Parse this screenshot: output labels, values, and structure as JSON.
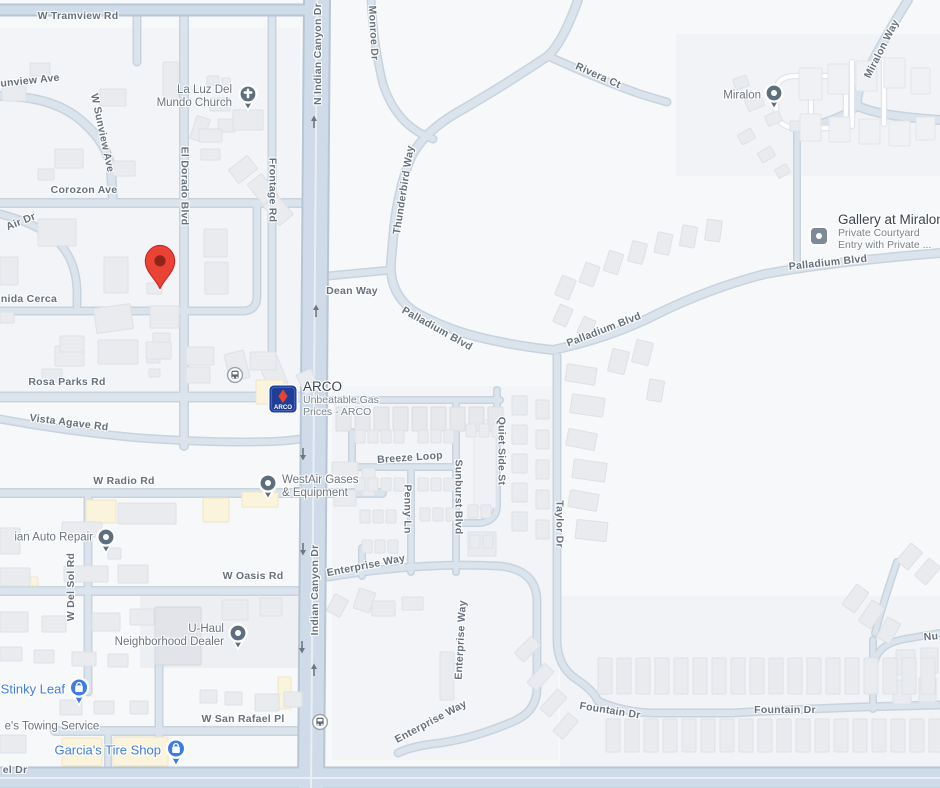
{
  "colors": {
    "land": "#F7F8FA",
    "road_major_fill": "#CFDBE8",
    "road_medium_fill": "#DBE4ED",
    "building_gray": "#E9EBEF",
    "building_commercial_cream": "#FBF4DC",
    "road_label_gray": "#67707D",
    "poi_label_gray": "#6D747E",
    "poi_blue": "#3E7DE1",
    "poi_icon_slate": "#5D6F7E",
    "pin_red": "#EA4335",
    "pin_red_dark": "#8F2418",
    "arco_navy": "#1E3E97",
    "arco_red": "#E8432D"
  },
  "roads": {
    "tramview": "W Tramview Rd",
    "sunview_cut": "unview Ave",
    "w_sunview": "W Sunview Ave",
    "corozon": "Corozon Ave",
    "air": "Air Dr",
    "el_dorado": "El Dorado Blvd",
    "frontage": "Frontage Rd",
    "n_indian_canyon": "N Indian Canyon Dr",
    "monroe": "Monroe Dr",
    "rivera": "Rivera Ct",
    "miralon_way": "Miralon Way",
    "thunderbird": "Thunderbird Way",
    "dean": "Dean Way",
    "palladium_1": "Palladium Blvd",
    "palladium_2": "Palladium Blvd",
    "palladium_3": "Palladium Blvd",
    "cerca": "nida Cerca",
    "rosa_parks": "Rosa Parks Rd",
    "vista_agave": "Vista Agave Rd",
    "breeze": "Breeze Loop",
    "penny": "Penny Ln",
    "sunburst": "Sunburst Blvd",
    "quiet_side": "Quiet Side St",
    "taylor": "Taylor Dr",
    "radio": "W Radio Rd",
    "del_sol": "W Del Sol Rd",
    "oasis": "W Oasis Rd",
    "enterprise_1": "Enterprise Way",
    "enterprise_2": "Enterprise Way",
    "enterprise_3": "Enterprise Way",
    "indian_canyon_mid": "Indian Canyon Dr",
    "san_rafael": "W San Rafael Pl",
    "fountain_1": "Fountain Dr",
    "fountain_2": "Fountain Dr",
    "nu": "Nu",
    "el_dr": "el Dr"
  },
  "pois": {
    "church": {
      "line1": "La Luz Del",
      "line2": "Mundo Church"
    },
    "miralon": {
      "name": "Miralon"
    },
    "gallery": {
      "title": "Gallery at Miralon",
      "sub1": "Private Courtyard",
      "sub2": "Entry with Private ..."
    },
    "arco": {
      "title": "ARCO",
      "sub1": "Unbeatable Gas",
      "sub2": "Prices - ARCO",
      "logo": "ARCO"
    },
    "westair": {
      "line1": "WestAir Gases",
      "line2": "& Equipment"
    },
    "auto_repair": {
      "name": "ian Auto Repair"
    },
    "uhaul": {
      "line1": "U-Haul",
      "line2": "Neighborhood Dealer"
    },
    "stinky_leaf": {
      "name": "Stinky Leaf"
    },
    "towing": {
      "name": "e's Towing Service"
    },
    "garcia": {
      "name": "Garcia's Tire Shop"
    }
  }
}
